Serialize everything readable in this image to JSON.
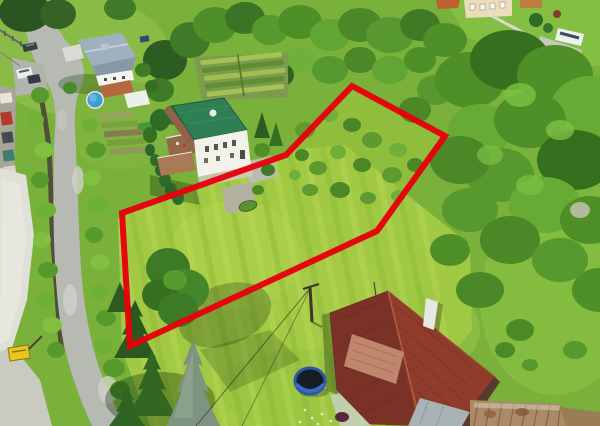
{
  "meta": {
    "type": "aerial-drone-photograph",
    "description": "Aerial photo of a grassy building plot outlined with a thick red boundary polygon, beside a white house with a green roof, a curving asphalt road with parked cars on the left, dense trees on the right, and a cottage with a red corrugated roof at the bottom.",
    "width": 600,
    "height": 426
  },
  "boundary": {
    "label": "plot-boundary",
    "color": "#e8000d",
    "stroke_width": 6,
    "points": "352,86 445,136 377,231 130,346 122,213 286,155"
  },
  "palette": {
    "grass_base": "#79b13a",
    "lawn_bright": "#a2c944",
    "meadow": "#8fbe3c",
    "forest_dark": "#35701f",
    "forest_mid": "#4f8f28",
    "forest_light": "#68ab34",
    "spruce_dark": "#2a581e",
    "spruce_blue": "#7e9480",
    "road": "#b6bab3",
    "road_light": "#cfd2ca",
    "wall_concrete": "#dfe0d8",
    "creek": "#4d4537",
    "house_white": "#f2f2ea",
    "house_cream": "#ecdcba",
    "roof_green": "#2f7f55",
    "roof_gray": "#9fb1bf",
    "roof_red": "#8f3c2c",
    "roof_red_dark": "#7b3226",
    "roof_faded": "#c68d74",
    "roof_rust": "#ab8a68",
    "pool_water": "#3f9bd3",
    "trampoline_ring": "#2e55a6",
    "trampoline_mat": "#141e24",
    "sign_yellow": "#e7c61e",
    "terrace_wood": "#96684a",
    "patio_stone": "#b3b0a2",
    "tarp_gray": "#a9b3b6",
    "car_dark": "#3a3f45",
    "van_white": "#e9ebe9"
  },
  "objects": [
    {
      "name": "plot-boundary",
      "desc": "red polygon outlining the plot for sale"
    },
    {
      "name": "mown-lawn",
      "desc": "bright striped mown lawn inside the plot"
    },
    {
      "name": "meadow-with-bushes",
      "desc": "rougher meadow with scattered shrubs in upper-right of plot"
    },
    {
      "name": "white-house-green-roof",
      "desc": "two-storey white house with dark green roof and terraces next to the plot"
    },
    {
      "name": "white-house-gray-roof",
      "desc": "house with grey roof, pool and garden beds at top left"
    },
    {
      "name": "cream-house",
      "desc": "cream house with lawn, path and camper at top right"
    },
    {
      "name": "red-roof-cottage",
      "desc": "cottage with red corrugated roof and white chimney at bottom"
    },
    {
      "name": "rusty-shed-roof",
      "desc": "old rusted corrugated roofs at bottom right"
    },
    {
      "name": "round-pool",
      "desc": "blue above-ground swimming pool"
    },
    {
      "name": "trampoline",
      "desc": "dark trampoline with blue rim on lawn"
    },
    {
      "name": "access-road",
      "desc": "asphalt road curving along the left side"
    },
    {
      "name": "retaining-wall",
      "desc": "light concrete wall along the road"
    },
    {
      "name": "creek",
      "desc": "dark ditch between wall and road"
    },
    {
      "name": "terraced-garden",
      "desc": "terraced vegetable rows on slope at top centre"
    },
    {
      "name": "parked-cars",
      "count": 3,
      "colors": [
        "dark-grey",
        "white",
        "dark-blue"
      ]
    },
    {
      "name": "roadside-vehicles-left-edge",
      "count": 5
    },
    {
      "name": "yellow-sign",
      "desc": "small yellow roadside board at bottom left"
    },
    {
      "name": "utility-pole",
      "desc": "wooden pole with two wires near the cottage"
    },
    {
      "name": "spruce-trees",
      "desc": "group of spruces incl. one silver-blue spruce at bottom left"
    },
    {
      "name": "forest",
      "desc": "dense deciduous trees on right side"
    }
  ]
}
